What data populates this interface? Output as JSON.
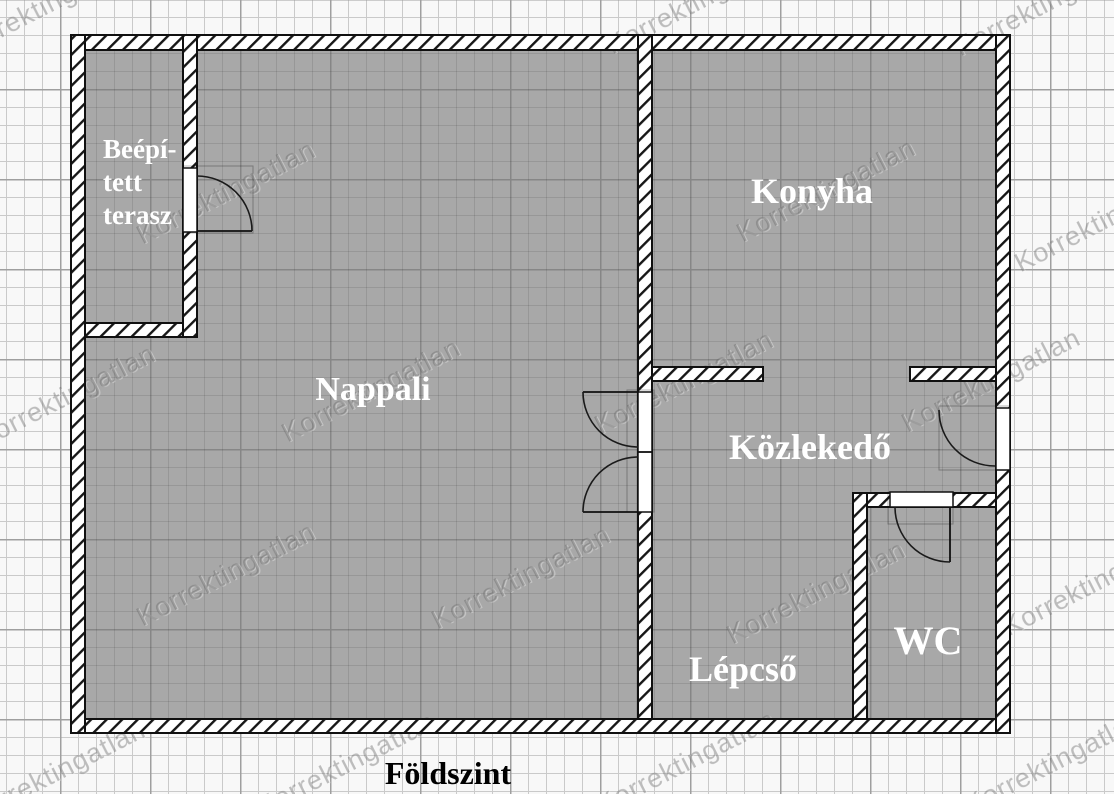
{
  "plan": {
    "title": "Földszint",
    "watermark_text": "Korrektingatlan",
    "rooms": {
      "terasz_line1": "Beépí-",
      "terasz_line2": "tett",
      "terasz_line3": "terasz",
      "nappali": "Nappali",
      "konyha": "Konyha",
      "kozlekedo": "Közlekedő",
      "lepcso": "Lépcső",
      "wc": "WC"
    },
    "colors": {
      "floor_fill": "#a8a8a8",
      "wall_fill": "#ffffff",
      "wall_hatch_line": "#161616",
      "outline": "#101010",
      "grid_minor_outside": "#cacaca",
      "grid_major_outside": "#9f9f9f",
      "room_label_text": "#ffffff",
      "title_text": "#000000"
    }
  }
}
